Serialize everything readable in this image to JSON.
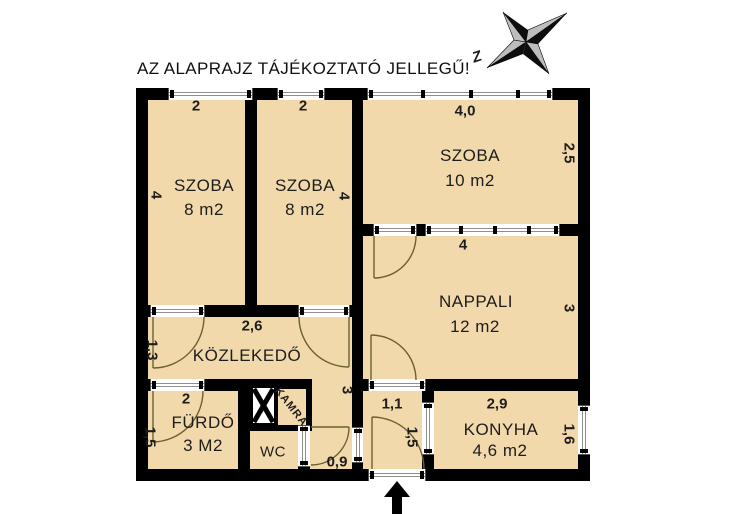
{
  "title": "AZ ALAPRAJZ TÁJÉKOZTATÓ JELLEGŰ!",
  "compass": {
    "north_label": "Z"
  },
  "rooms": {
    "szoba1": {
      "name": "SZOBA",
      "area": "8 m2"
    },
    "szoba2": {
      "name": "SZOBA",
      "area": "8 m2"
    },
    "szoba3": {
      "name": "SZOBA",
      "area": "10 m2"
    },
    "nappali": {
      "name": "NAPPALI",
      "area": "12 m2"
    },
    "kozlekedo": {
      "name": "KÖZLEKEDŐ"
    },
    "furdo": {
      "name": "FÜRDŐ",
      "area": "3 M2"
    },
    "wc": {
      "name": "WC"
    },
    "kamra": {
      "name": "KAMRA"
    },
    "konyha": {
      "name": "KONYHA",
      "area": "4,6 m2"
    }
  },
  "dims": {
    "szoba1_top": "2",
    "szoba2_top": "2",
    "szoba3_top": "4,0",
    "szoba3_right": "2,5",
    "szoba1_left": "4",
    "szoba2_right": "4",
    "nappali_top": "4",
    "nappali_right": "3",
    "hall_width": "2,6",
    "hall_left": "1,3",
    "hall_right": "3",
    "furdo_top": "2",
    "furdo_left": "1,5",
    "corridor_width": "0,9",
    "entry_width": "1,1",
    "entry_depth": "1,5",
    "konyha_top": "2,9",
    "konyha_right": "1,6"
  },
  "colors": {
    "room_fill": "#f2d9ab",
    "wall": "#000000",
    "door_arc": "#6b5f33",
    "compass_light": "#bdbdbd",
    "compass_dark": "#0d0d0d"
  }
}
